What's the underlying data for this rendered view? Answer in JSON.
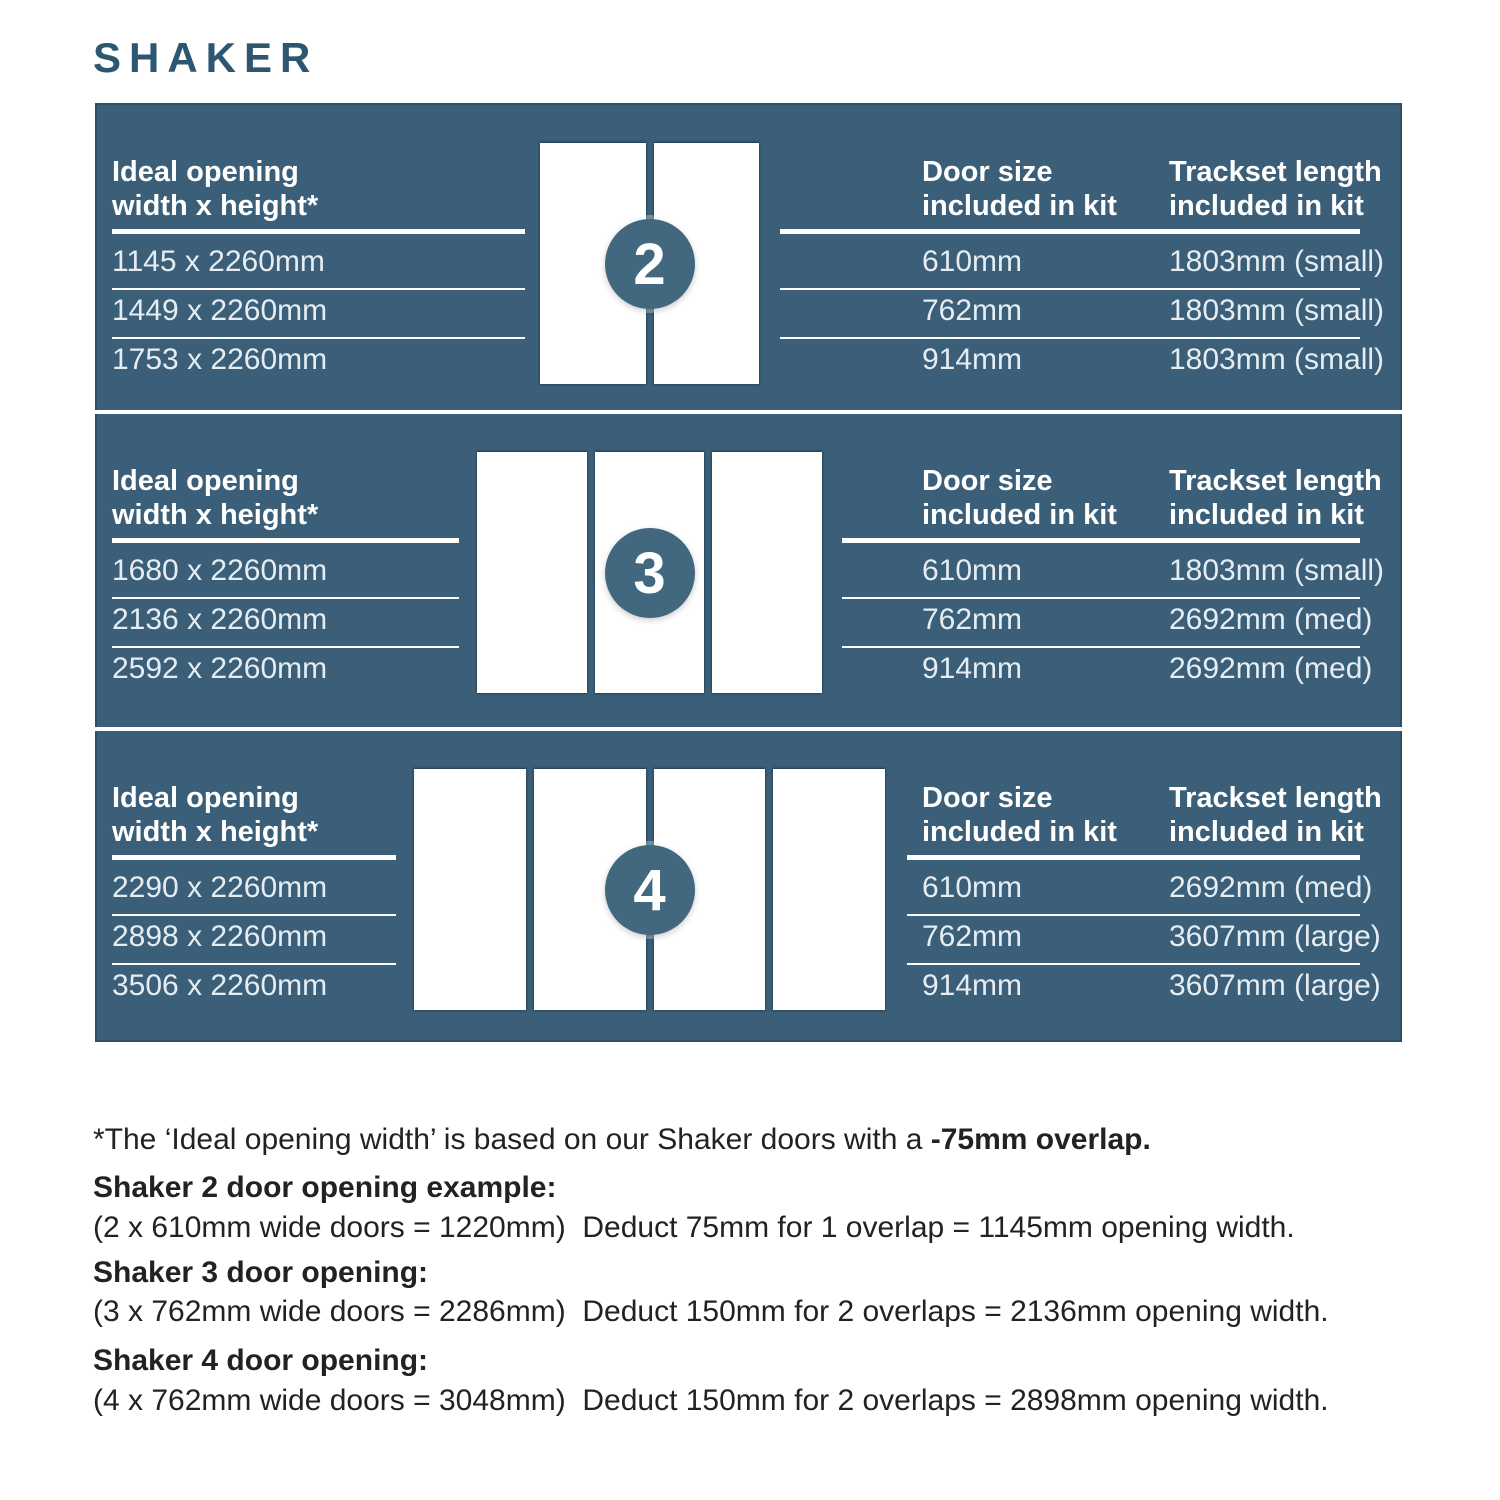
{
  "title": "SHAKER",
  "colors": {
    "panel_background": "#3B5F78",
    "badge_background": "#41687F",
    "title_text": "#2D5670",
    "panel_text": "#FFFFFF",
    "body_text": "#222222",
    "door_fill": "#FFFFFF"
  },
  "headers": {
    "opening_line1": "Ideal opening",
    "opening_line2": "width x height*",
    "door_size_line1": "Door size",
    "door_size_line2": "included in kit",
    "trackset_line1": "Trackset length",
    "trackset_line2": "included in kit"
  },
  "sections": [
    {
      "badge": "2",
      "door_count": 2,
      "openings": [
        "1145 x 2260mm",
        "1449 x 2260mm",
        "1753 x 2260mm"
      ],
      "door_sizes": [
        "610mm",
        "762mm",
        "914mm"
      ],
      "tracksets": [
        "1803mm (small)",
        "1803mm (small)",
        "1803mm (small)"
      ]
    },
    {
      "badge": "3",
      "door_count": 3,
      "openings": [
        "1680 x 2260mm",
        "2136 x 2260mm",
        "2592 x 2260mm"
      ],
      "door_sizes": [
        "610mm",
        "762mm",
        "914mm"
      ],
      "tracksets": [
        "1803mm (small)",
        "2692mm (med)",
        "2692mm (med)"
      ]
    },
    {
      "badge": "4",
      "door_count": 4,
      "openings": [
        "2290 x 2260mm",
        "2898 x 2260mm",
        "3506 x 2260mm"
      ],
      "door_sizes": [
        "610mm",
        "762mm",
        "914mm"
      ],
      "tracksets": [
        "2692mm (med)",
        "3607mm (large)",
        "3607mm (large)"
      ]
    }
  ],
  "footnote": {
    "regular": "*The ‘Ideal opening width’ is based on our Shaker doors with a ",
    "bold": "-75mm overlap."
  },
  "examples": [
    {
      "heading": "Shaker 2 door opening example:",
      "body": "(2 x 610mm wide doors = 1220mm)  Deduct 75mm for 1 overlap = 1145mm opening width."
    },
    {
      "heading": "Shaker 3 door opening:",
      "body": "(3 x 762mm wide doors = 2286mm)  Deduct 150mm for 2 overlaps = 2136mm opening width."
    },
    {
      "heading": "Shaker 4 door opening:",
      "body": "(4 x 762mm wide doors = 3048mm)  Deduct 150mm for 2 overlaps = 2898mm opening width."
    }
  ]
}
